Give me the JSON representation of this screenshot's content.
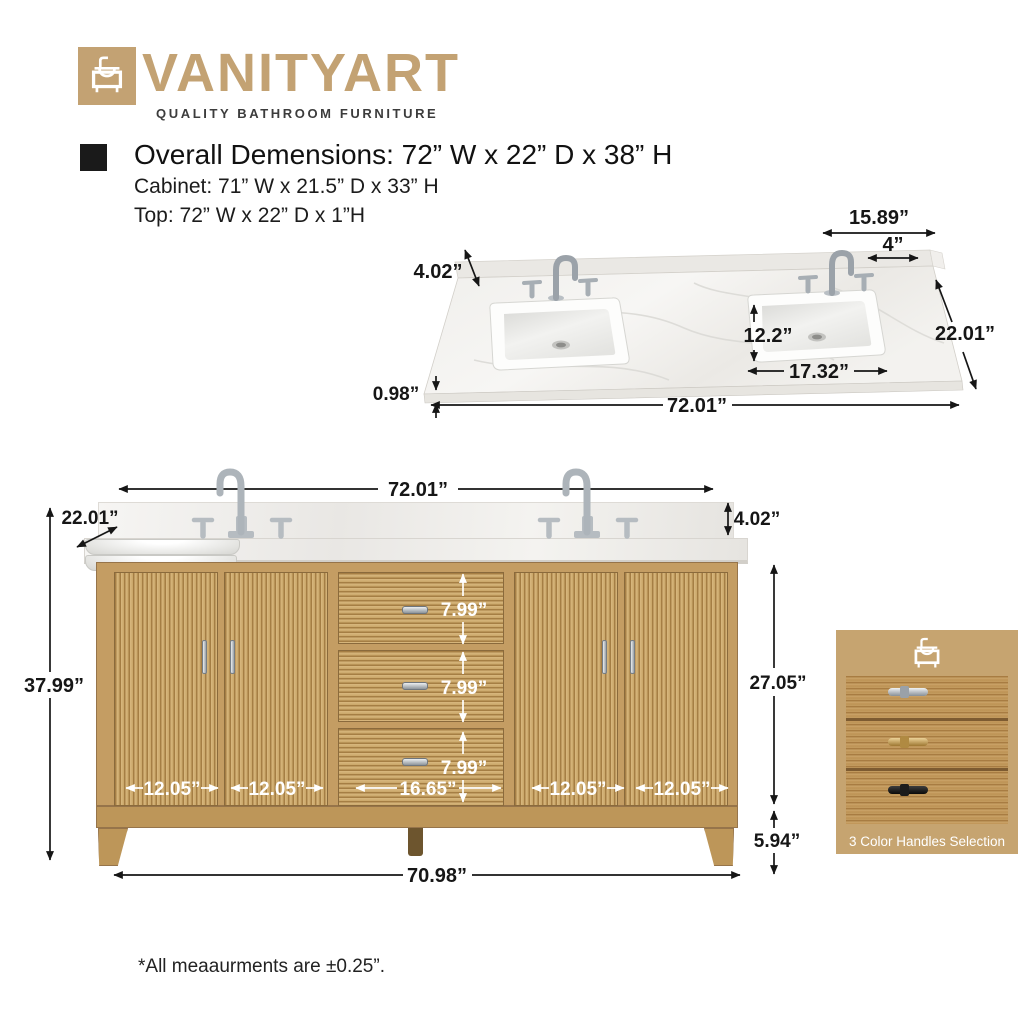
{
  "brand": {
    "name": "VANITYART",
    "tagline": "QUALITY BATHROOM FURNITURE",
    "accent_color": "#c3a273"
  },
  "specs": {
    "overall": "Overall Demensions: 72” W x 22” D x 38” H",
    "cabinet": "Cabinet: 71” W x 21.5” D x 33” H",
    "top": "Top: 72” W x 22” D x 1”H"
  },
  "top_view": {
    "right_offset": "15.89”",
    "faucet_span": "4”",
    "backsplash_height": "4.02”",
    "sink_front_depth": "12.2”",
    "depth": "22.01”",
    "sink_width": "17.32”",
    "top_thickness": "0.98”",
    "width": "72.01”"
  },
  "front_view": {
    "width_top": "72.01”",
    "depth": "22.01”",
    "backsplash_height": "4.02”",
    "height_total": "37.99”",
    "cabinet_height": "27.05”",
    "leg_height": "5.94”",
    "width_bottom": "70.98”",
    "drawer_heights": [
      "7.99”",
      "7.99”",
      "7.99”"
    ],
    "drawer_width": "16.65”",
    "door_widths": [
      "12.05”",
      "12.05”",
      "12.05”",
      "12.05”"
    ]
  },
  "handles": {
    "caption": "3 Color Handles Selection",
    "options": [
      "chrome",
      "gold",
      "black"
    ],
    "colors": {
      "chrome": "#c0c6cc",
      "gold": "#c9a050",
      "black": "#1a1a1a"
    }
  },
  "materials": {
    "wood": "#c49d63",
    "marble": "#f2f1ee"
  },
  "footnote": "*All meaaurments are ±0.25”."
}
